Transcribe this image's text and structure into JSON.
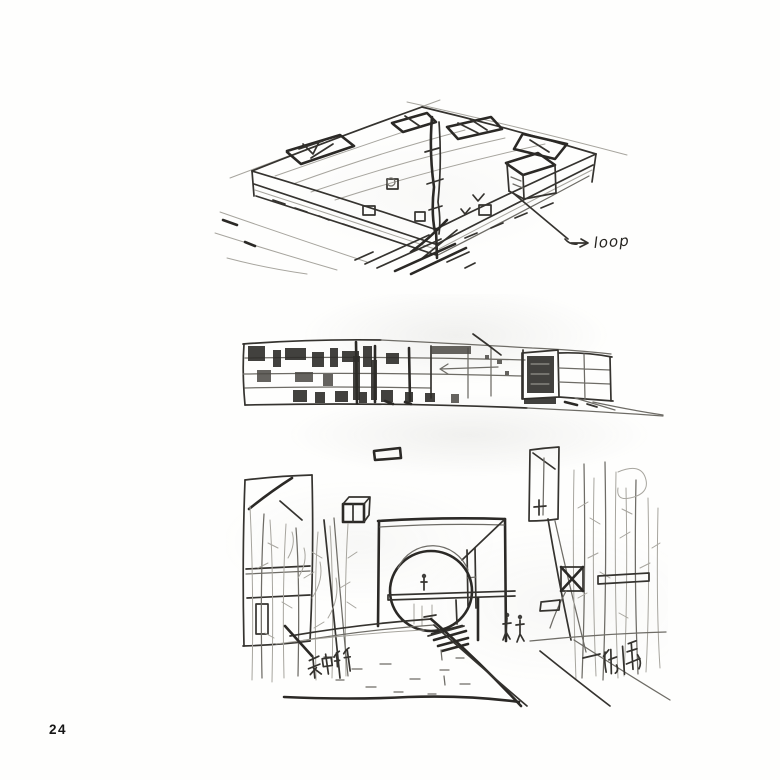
{
  "page": {
    "number": "24"
  },
  "colors": {
    "paper": "#fefefd",
    "pencil_dark": "#2b2926",
    "pencil_medium": "#35332f",
    "pencil_light": "#a7a59e",
    "scan_wash": "#f2f2ef"
  },
  "figures": {
    "top": {
      "name": "aerial-perspective-sketch-of-courtyard-building",
      "annotation": "loop"
    },
    "middle": {
      "name": "long-building-elevation-sketch"
    },
    "bottom": {
      "name": "gate-plaza-perspective-sketch",
      "annotation_left": "种竹",
      "annotation_right": "阶梯"
    }
  }
}
